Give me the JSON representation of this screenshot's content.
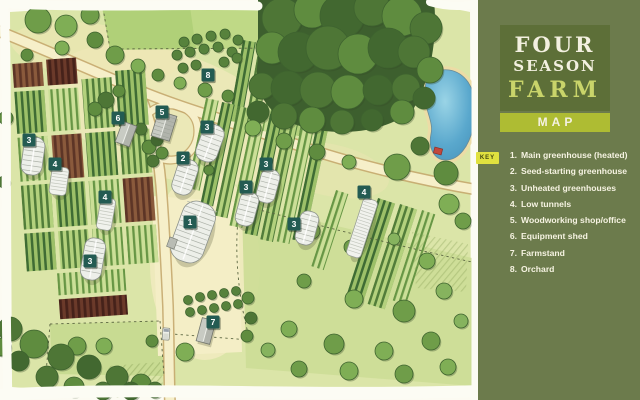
{
  "sidebar": {
    "title_line1": "FOUR",
    "title_line2": "SEASON",
    "title_line3": "FARM",
    "map_label": "MAP",
    "key_tag": "KEY",
    "key_items": [
      {
        "num": "1.",
        "label": "Main greenhouse (heated)"
      },
      {
        "num": "2.",
        "label": "Seed-starting greenhouse"
      },
      {
        "num": "3.",
        "label": "Unheated greenhouses"
      },
      {
        "num": "4.",
        "label": "Low tunnels"
      },
      {
        "num": "5.",
        "label": "Woodworking shop/office"
      },
      {
        "num": "6.",
        "label": "Equipment shed"
      },
      {
        "num": "7.",
        "label": "Farmstand"
      },
      {
        "num": "8.",
        "label": "Orchard"
      }
    ],
    "colors": {
      "background": "#6c7b4c",
      "title_box": "#5d6f38",
      "map_bar": "#aebc33",
      "title_text": "#f3f0e0",
      "farm_text": "#c9d46a"
    }
  },
  "map": {
    "marker_color": "#235b52",
    "marker_text_color": "#ffffff",
    "markers": [
      {
        "n": "1",
        "x": 190,
        "y": 222
      },
      {
        "n": "2",
        "x": 183,
        "y": 158
      },
      {
        "n": "3",
        "x": 29,
        "y": 140
      },
      {
        "n": "3",
        "x": 207,
        "y": 127
      },
      {
        "n": "3",
        "x": 266,
        "y": 164
      },
      {
        "n": "3",
        "x": 246,
        "y": 187
      },
      {
        "n": "3",
        "x": 294,
        "y": 224
      },
      {
        "n": "3",
        "x": 90,
        "y": 261
      },
      {
        "n": "4",
        "x": 55,
        "y": 164
      },
      {
        "n": "4",
        "x": 105,
        "y": 197
      },
      {
        "n": "4",
        "x": 364,
        "y": 192
      },
      {
        "n": "5",
        "x": 162,
        "y": 112
      },
      {
        "n": "6",
        "x": 118,
        "y": 118
      },
      {
        "n": "7",
        "x": 213,
        "y": 322
      },
      {
        "n": "8",
        "x": 208,
        "y": 75
      }
    ]
  }
}
